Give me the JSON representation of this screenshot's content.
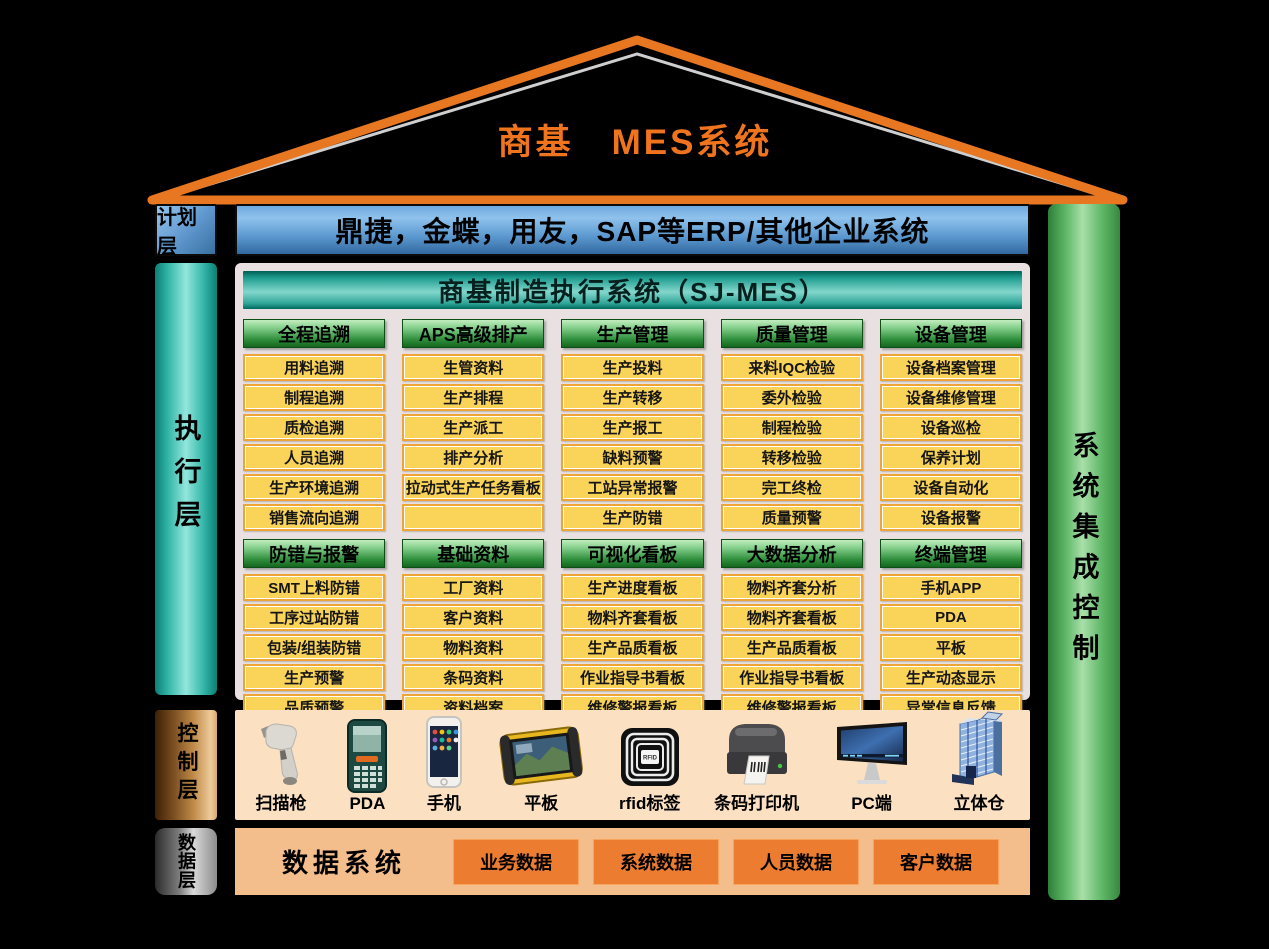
{
  "roof": {
    "title": "商基　MES系统"
  },
  "plan_layer": {
    "label": "计划层",
    "erp_text": "鼎捷，金蝶，用友，SAP等ERP/其他企业系统"
  },
  "execution_layer": {
    "label": "执行层"
  },
  "control_layer": {
    "label": "控制层"
  },
  "data_layer": {
    "label": "数据层",
    "title": "数据系统",
    "buttons": [
      "业务数据",
      "系统数据",
      "人员数据",
      "客户数据"
    ]
  },
  "integration_bar": {
    "label": "系统集成控制"
  },
  "mes": {
    "header": "商基制造执行系统（SJ-MES）",
    "rows": [
      [
        {
          "header": "全程追溯",
          "items": [
            "用料追溯",
            "制程追溯",
            "质检追溯",
            "人员追溯",
            "生产环境追溯",
            "销售流向追溯"
          ]
        },
        {
          "header": "APS高级排产",
          "items": [
            "生管资料",
            "生产排程",
            "生产派工",
            "排产分析",
            "拉动式生产任务看板",
            ""
          ]
        },
        {
          "header": "生产管理",
          "items": [
            "生产投料",
            "生产转移",
            "生产报工",
            "缺料预警",
            "工站异常报警",
            "生产防错"
          ]
        },
        {
          "header": "质量管理",
          "items": [
            "来料IQC检验",
            "委外检验",
            "制程检验",
            "转移检验",
            "完工终检",
            "质量预警"
          ]
        },
        {
          "header": "设备管理",
          "items": [
            "设备档案管理",
            "设备维修管理",
            "设备巡检",
            "保养计划",
            "设备自动化",
            "设备报警"
          ]
        }
      ],
      [
        {
          "header": "防错与报警",
          "items": [
            "SMT上料防错",
            "工序过站防错",
            "包装/组装防错",
            "生产预警",
            "品质预警",
            "设备报警"
          ]
        },
        {
          "header": "基础资料",
          "items": [
            "工厂资料",
            "客户资料",
            "物料资料",
            "条码资料",
            "资料档案",
            "资料查询"
          ]
        },
        {
          "header": "可视化看板",
          "items": [
            "生产进度看板",
            "物料齐套看板",
            "生产品质看板",
            "作业指导书看板",
            "维修警报看板",
            "看板分页显示"
          ]
        },
        {
          "header": "大数据分析",
          "items": [
            "物料齐套分析",
            "物料齐套看板",
            "生产品质看板",
            "作业指导书看板",
            "维修警报看板",
            "看板分页显示"
          ]
        },
        {
          "header": "终端管理",
          "items": [
            "手机APP",
            "PDA",
            "平板",
            "生产动态显示",
            "异常信息反馈",
            ""
          ]
        }
      ]
    ]
  },
  "devices": [
    {
      "icon": "scanner-gun-icon",
      "label": "扫描枪"
    },
    {
      "icon": "pda-icon",
      "label": "PDA"
    },
    {
      "icon": "smartphone-icon",
      "label": "手机"
    },
    {
      "icon": "rugged-tablet-icon",
      "label": "平板"
    },
    {
      "icon": "rfid-tag-icon",
      "label": "rfid标签"
    },
    {
      "icon": "barcode-printer-icon",
      "label": "条码打印机"
    },
    {
      "icon": "pc-monitor-icon",
      "label": "PC端"
    },
    {
      "icon": "warehouse-icon",
      "label": "立体仓"
    }
  ],
  "colors": {
    "accent_orange": "#F0741E",
    "roof_stroke": "#E87722",
    "yellow_box": "#FAD359",
    "yellow_border": "#EFA536",
    "green_header": "#2F8F3C",
    "teal_bar": "#35B7A9",
    "blue_bar": "#5D9AD1",
    "devices_bg": "#FCE0C2",
    "data_bg": "#F4BE8C",
    "data_button": "#EC7C2F"
  }
}
